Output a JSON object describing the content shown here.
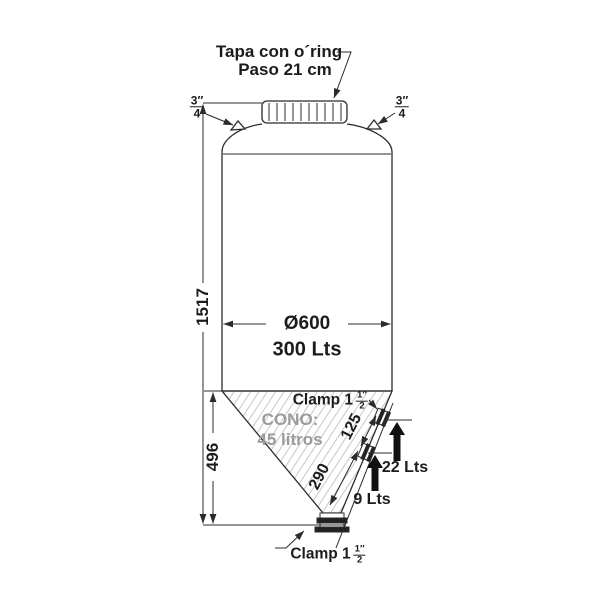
{
  "labels": {
    "lid_line1": "Tapa con o´ring",
    "lid_line2": "Paso 21 cm",
    "top_fitting_left": {
      "num": "3",
      "den": "4",
      "unit": "″"
    },
    "top_fitting_right": {
      "num": "3",
      "den": "4",
      "unit": "″"
    },
    "total_height": "1517",
    "diameter": "Ø600",
    "capacity": "300 Lts",
    "cone_height": "496",
    "cone_line1": "CONO:",
    "cone_line2": "45 litros",
    "clamp_upper": {
      "text": "Clamp 1",
      "num": "1",
      "den": "2",
      "unit": "″"
    },
    "clamp_bottom": {
      "text": "Clamp 1",
      "num": "1",
      "den": "2",
      "unit": "″"
    },
    "slope_dim_upper": "125",
    "slope_dim_lower": "290",
    "tap_upper": "22 Lts",
    "tap_lower": "9 Lts"
  },
  "colors": {
    "line": "#2b2b2b",
    "hatch": "#c7c7c7",
    "muted_text": "#9b9b9b",
    "arrow_fill": "#111111",
    "background": "#ffffff"
  }
}
